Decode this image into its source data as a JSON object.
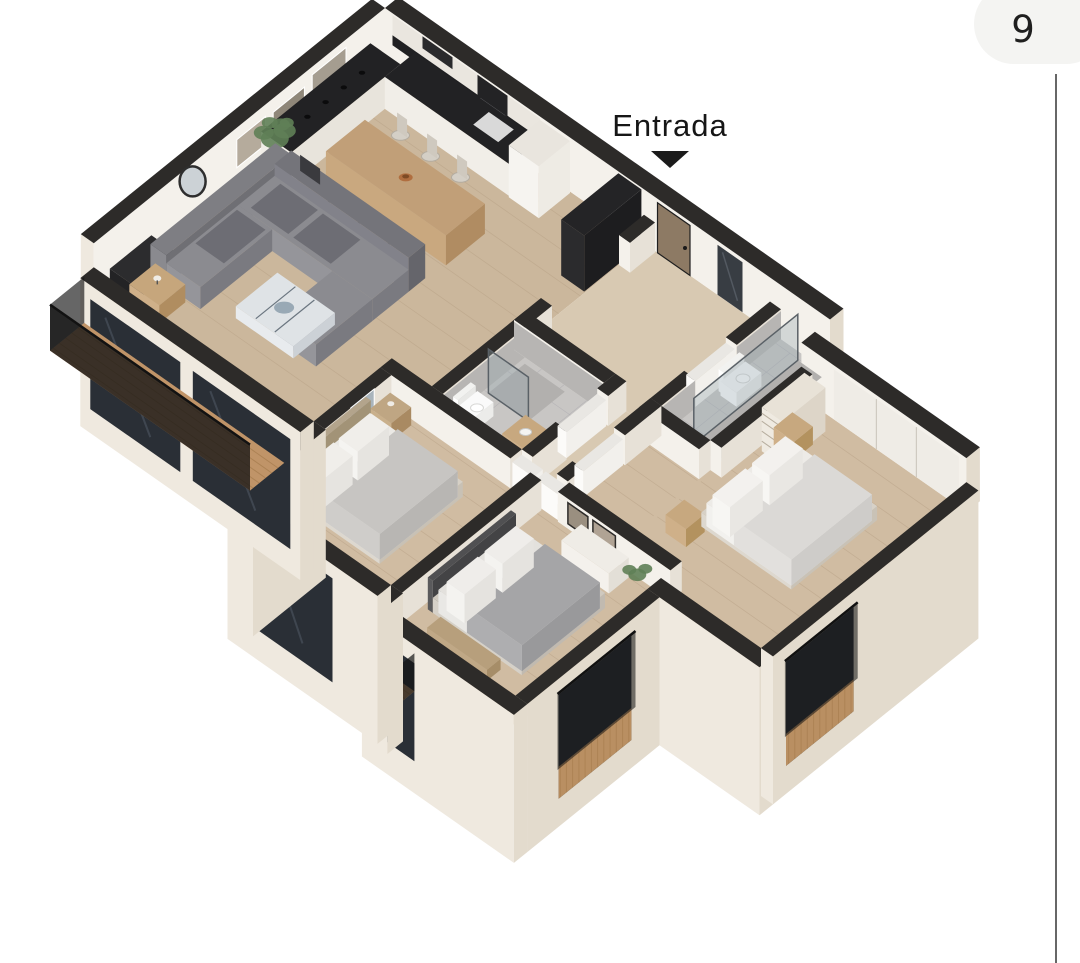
{
  "entrance": {
    "label": "Entrada",
    "marker_icon": "triangle-down-icon"
  },
  "gallery": {
    "image_counter": "9"
  },
  "colors": {
    "background": "#ffffff",
    "wall_top": "#2d2b29",
    "wall_face": "#f4f1eb",
    "wall_face_shade": "#e7e1d7",
    "facade": "#efe9df",
    "facade_shade": "#e3dbcd",
    "floor_wood": "#cbb79c",
    "floor_wood_bed": "#d0bca2",
    "floor_hall": "#d8c9b2",
    "floor_tile": "#c8c6c4",
    "tile_wall": "#b7b5b3",
    "glass": "#2a2f36",
    "glass_streak": "#49515b",
    "deck_wood": "#c09468",
    "deck_stripe": "#a87e50",
    "railing": "#1c1c1c",
    "sofa": "#8a8a8f",
    "sofa_dark": "#6e6e74",
    "cushion": "#56565c",
    "table_wood": "#c2a37e",
    "table_wood_dark": "#ab8a62",
    "linen": "#ebe9e5",
    "blanket": "#c7c5c2",
    "blanket_dark": "#a5a5a7",
    "counter_dark": "#222224",
    "cabinet_white": "#f2efe9",
    "marble": "#dfe3e6",
    "plant_green": "#5f7f57",
    "badge_bg": "#f4f4f2",
    "badge_text": "#1f1f1f",
    "divider": "#4c4c4c",
    "label_text": "#161616"
  }
}
